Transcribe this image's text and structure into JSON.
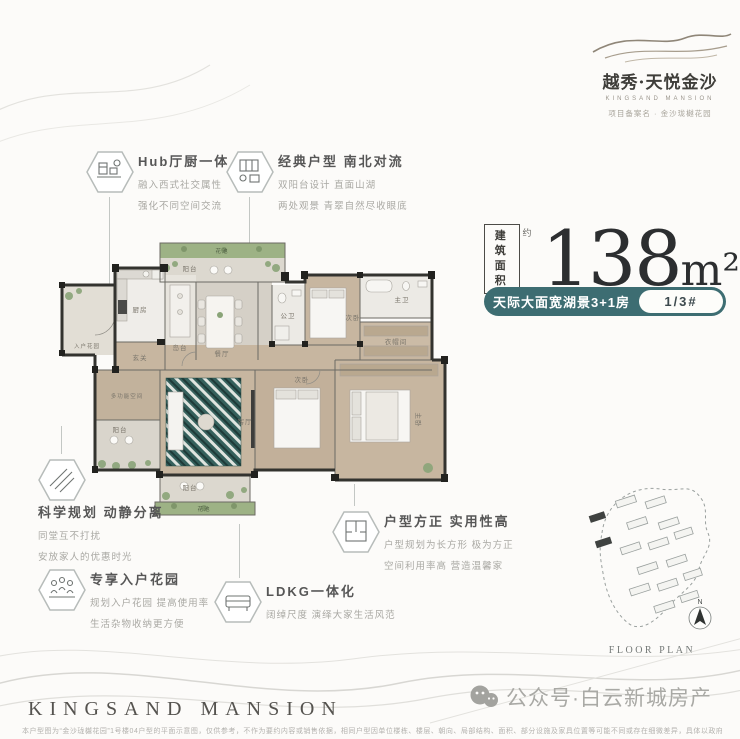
{
  "colors": {
    "accent_teal": "#3d6d72",
    "wall": "#33332f",
    "rug_teal": "#35605c",
    "flower_green": "#9db285"
  },
  "logo": {
    "title": "越秀·天悦金沙",
    "en": "KINGSAND MANSION",
    "tagline": "项目备案名 · 金沙珑樾花园"
  },
  "callouts": {
    "hub": {
      "title": "Hub厅厨一体",
      "line1": "融入西式社交属性",
      "line2": "强化不同空间交流"
    },
    "classic": {
      "title": "经典户型 南北对流",
      "line1": "双阳台设计 直面山湖",
      "line2": "两处观景 青翠自然尽收眼底"
    },
    "sci": {
      "title": "科学规划 动静分离",
      "line1": "同堂互不打扰",
      "line2": "安放家人的优惠时光"
    },
    "garden": {
      "title": "专享入户花园",
      "line1": "规划入户花园 提高使用率",
      "line2": "生活杂物收纳更方便"
    },
    "ldkg": {
      "title": "LDKG一体化",
      "line1": "阔绰尺度 演绎大家生活风范"
    },
    "square": {
      "title": "户型方正 实用性高",
      "line1": "户型规划为长方形 极为方正",
      "line2": "空间利用率高 营造温馨家"
    }
  },
  "area": {
    "badge1": "建筑",
    "badge2": "面积",
    "approx": "约",
    "value": "138",
    "unit": "m²"
  },
  "pill": {
    "label": "天际大面宽湖景3+1房",
    "unit_no": "1/3#"
  },
  "floorplan": {
    "rooms": [
      {
        "label": "花池"
      },
      {
        "label": "阳台"
      },
      {
        "label": "厨房"
      },
      {
        "label": "岛台"
      },
      {
        "label": "餐厅"
      },
      {
        "label": "玄关"
      },
      {
        "label": "入户花园"
      },
      {
        "label": "多功能空间"
      },
      {
        "label": "阳台"
      },
      {
        "label": "客厅"
      },
      {
        "label": "阳台"
      },
      {
        "label": "花池"
      },
      {
        "label": "公卫"
      },
      {
        "label": "次卧"
      },
      {
        "label": "主卫"
      },
      {
        "label": "衣帽间"
      },
      {
        "label": "次卧"
      },
      {
        "label": "主卧"
      }
    ]
  },
  "siteplan": {
    "caption": "FLOOR PLAN",
    "compass_n": "N"
  },
  "footer": {
    "brand": "KINGSAND MANSION",
    "disclaimer": "本户型图为“金沙珑樾花园”1号楼04户型的平面示意图，仅供参考，不作为要约内容或销售依据，相同户型因单位楼栋、楼层、朝向、局部结构、面积、部分设施及家具位置等可能不同或存在细微差异，具体以政府部门审批文件和双方签署的商品房买卖合同的约定为准。",
    "watermark": "公众号·白云新城房产"
  }
}
